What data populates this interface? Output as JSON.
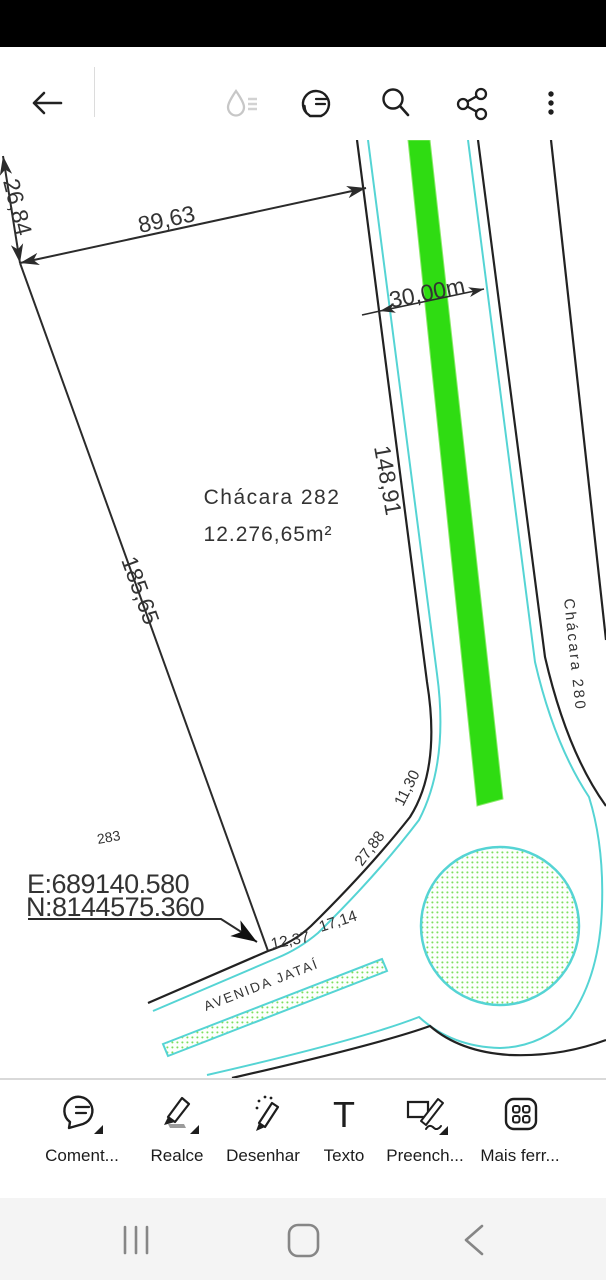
{
  "topbar": {
    "icons": [
      "back-arrow",
      "ink-drop",
      "comments-list",
      "search",
      "share",
      "overflow-menu"
    ]
  },
  "drawing": {
    "parcel_name": "Chácara 282",
    "parcel_area": "12.276,65m²",
    "neighbor_label": "Chácara 280",
    "lot_number": "283",
    "coord_e": "E:689140.580",
    "coord_n": "N:8144575.360",
    "street_name": "AVENIDA JATAÍ",
    "dim_top": "89,63",
    "dim_upper_left": "26,84",
    "dim_left": "185,65",
    "dim_right": "148,91",
    "road_width": "30,00m",
    "curve_dims": [
      "12,37",
      "17,14",
      "27,88",
      "11,30"
    ],
    "colors": {
      "line_black": "#222222",
      "cyan": "#55d4d4",
      "median_green": "#2fdc12",
      "dot_green": "#7ddf5e",
      "text": "#333333"
    }
  },
  "bottom_toolbar": {
    "items": [
      {
        "label": "Coment...",
        "icon": "comment-tool"
      },
      {
        "label": "Realce",
        "icon": "highlight-tool"
      },
      {
        "label": "Desenhar",
        "icon": "draw-tool"
      },
      {
        "label": "Texto",
        "icon": "text-tool",
        "glyph": "T"
      },
      {
        "label": "Preench...",
        "icon": "fill-sign-tool"
      },
      {
        "label": "Mais ferr...",
        "icon": "more-tools"
      }
    ]
  },
  "nav_bar": {
    "icons": [
      "recents",
      "home",
      "back"
    ]
  }
}
